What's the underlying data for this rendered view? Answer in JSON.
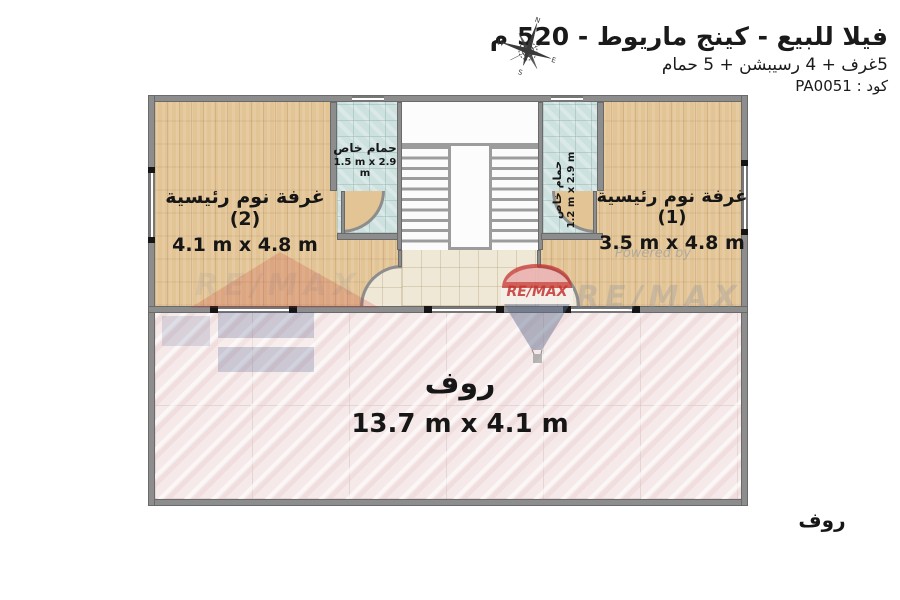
{
  "header": {
    "title": "فيلا للبيع - كينج ماريوط - 520 م",
    "subtitle": "5غرف + 4 رسيبشن + 5 حمام",
    "code": "كود : PA0051"
  },
  "compass": {
    "directions": [
      "N",
      "E",
      "S",
      "W"
    ]
  },
  "rooms": {
    "bedroom2": {
      "name": "غرفة نوم رئيسية (2)",
      "dimensions": "4.1 m x 4.8 m"
    },
    "bedroom1": {
      "name": "غرفة نوم رئيسية (1)",
      "dimensions": "3.5 m x 4.8 m"
    },
    "bathroom_left": {
      "name": "حمام خاص",
      "dimensions": "1.5 m x 2.9 m"
    },
    "bathroom_right": {
      "name": "حمام خاص",
      "dimensions": "1.2 m x 2.9 m"
    },
    "roof": {
      "name": "روف",
      "dimensions": "13.7 m x 4.1 m"
    }
  },
  "labels": {
    "roof_outside": "روف"
  },
  "watermark": {
    "brand": "RE/MAX",
    "powered_by": "Powered by"
  },
  "colors": {
    "wood": "#e2c495",
    "bathroom_tile": "#cde2df",
    "hallway_tile": "#f0e8d6",
    "roof_floor": "#f6e9e9",
    "wall": "#8d8d8d",
    "remax_red": "#c63430",
    "remax_blue": "#27447e"
  }
}
